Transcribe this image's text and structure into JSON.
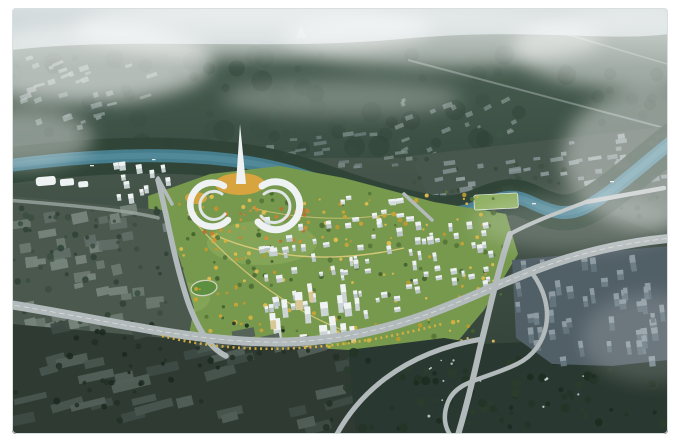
{
  "scene": {
    "description": "Aerial masterplan rendering: misty forested mountain, teal river, colorful new town center with crescent landmark buildings and spire, highway interchange, surrounding grey city blocks, industrial sheds and residential slabs",
    "kind": "architectural-aerial-rendering"
  },
  "colors": {
    "frame_white": "#ffffff",
    "sky_top": "#a9b8ba",
    "sky_bottom": "#8aa0a0",
    "mountain_top": "#4a5f52",
    "mountain_bottom": "#33463c",
    "land_top": "#46564b",
    "land_bottom": "#2f3e34",
    "east_zone": "#47574d",
    "river": "#477e8e",
    "river_core": "#5b93a3",
    "river_bank": "#2f4537",
    "dev_green": "#77994e",
    "dev_park": "#8fae5e",
    "stadium_green": "#5d8f41",
    "stadium_ring": "#ccd2bc",
    "green_roof": "#8fb062",
    "plaza_orange": "#dca43e",
    "building_white": "#eef2f3",
    "building_inner": "#dfe6e5",
    "path_gold": "#e4cf7e",
    "tree_line_yellow": "#d8b23e",
    "road_light": "#b3babb",
    "road_lane": "#e8ecec",
    "road_minor": "#9aa8a2",
    "left_city_base": "#4a584e",
    "industrial_base": "#2e3a32",
    "forest_base": "#293830",
    "residential_base": "#515f66",
    "fog": "#ffffff",
    "border": "#d9dede"
  },
  "scatters": [
    {
      "target": "mountain-texture",
      "name": "mountain-foliage",
      "type": "dot",
      "region": [
        0,
        46,
        656,
        148
      ],
      "count": 150,
      "rmin": 3,
      "rmax": 11,
      "colors": [
        "#3b5044",
        "#324539",
        "#43594a",
        "#2d3f34"
      ],
      "opacity": 0.38,
      "seed": 11
    },
    {
      "target": "distant-city-tl",
      "name": "distant-building",
      "type": "rect",
      "region": [
        8,
        50,
        132,
        72
      ],
      "count": 32,
      "wmin": 4,
      "wmax": 12,
      "hmin": 2.5,
      "hmax": 6,
      "rot": -18,
      "jitter": 10,
      "colors": [
        "#aab7b7",
        "#b8c3c3",
        "#9dacac"
      ],
      "opacity": 0.5,
      "seed": 12
    },
    {
      "target": "distant-city-tr",
      "name": "distant-building",
      "type": "rect",
      "region": [
        372,
        90,
        168,
        80
      ],
      "count": 30,
      "wmin": 3,
      "wmax": 10,
      "hmin": 2.5,
      "hmax": 5,
      "rot": -25,
      "jitter": 12,
      "colors": [
        "#a3b1b1",
        "#afbcbc"
      ],
      "opacity": 0.45,
      "seed": 13
    },
    {
      "target": "northbank-town-west",
      "name": "town-block",
      "type": "rect",
      "region": [
        246,
        126,
        152,
        36
      ],
      "count": 20,
      "wmin": 5,
      "wmax": 13,
      "hmin": 2.5,
      "hmax": 4.5,
      "rot": -6,
      "jitter": 6,
      "colors": [
        "#8a9997",
        "#7a8a8b"
      ],
      "opacity": 0.65,
      "seed": 14
    },
    {
      "target": "northbank-town-mid",
      "name": "town-block",
      "type": "rect",
      "region": [
        420,
        150,
        120,
        52
      ],
      "count": 22,
      "wmin": 5,
      "wmax": 14,
      "hmin": 3,
      "hmax": 5.5,
      "rot": -8,
      "jitter": 8,
      "colors": [
        "#94a2a2",
        "#a1aeae",
        "#879696"
      ],
      "opacity": 0.8,
      "seed": 15
    },
    {
      "target": "northbank-town-east",
      "name": "town-block",
      "type": "rect",
      "region": [
        544,
        126,
        112,
        50
      ],
      "count": 26,
      "wmin": 5,
      "wmax": 14,
      "hmin": 3,
      "hmax": 5.5,
      "rot": -8,
      "jitter": 8,
      "colors": [
        "#94a2a2",
        "#a1aeae",
        "#879696"
      ],
      "opacity": 0.8,
      "seed": 35
    },
    {
      "target": "east-zone-trees",
      "name": "tree",
      "type": "dot",
      "region": [
        400,
        150,
        256,
        60
      ],
      "count": 40,
      "rmin": 1.5,
      "rmax": 3,
      "colors": [
        "#3c5142",
        "#334639"
      ],
      "opacity": 0.7,
      "seed": 31
    },
    {
      "target": "dev-green-trees",
      "name": "tree",
      "type": "dot",
      "region": [
        140,
        182,
        352,
        172
      ],
      "count": 95,
      "rmin": 1.2,
      "rmax": 3,
      "colors": [
        "#4c6a35",
        "#557538",
        "#42602e"
      ],
      "opacity": 0.9,
      "seed": 16
    },
    {
      "target": "dev-yellow-trees",
      "name": "autumn-tree",
      "type": "dot",
      "region": [
        146,
        186,
        336,
        160
      ],
      "count": 170,
      "rmin": 1,
      "rmax": 2.4,
      "colors": [
        "#d5b13d",
        "#c9a435",
        "#e0bd4e",
        "#b99a30"
      ],
      "opacity": 0.95,
      "seed": 17
    },
    {
      "target": "dev-orange-trees",
      "name": "autumn-tree",
      "type": "dot",
      "region": [
        188,
        198,
        110,
        36
      ],
      "count": 40,
      "rmin": 1,
      "rmax": 2.2,
      "colors": [
        "#c97f35",
        "#d18f3a",
        "#bd6f2e"
      ],
      "opacity": 0.95,
      "seed": 18
    },
    {
      "target": "dev-buildings",
      "name": "new-town-building",
      "type": "rect",
      "region": [
        250,
        212,
        162,
        96
      ],
      "count": 58,
      "wmin": 3,
      "wmax": 6.5,
      "hmin": 4,
      "hmax": 10,
      "rot": -8,
      "jitter": 6,
      "colors": [
        "#c5ced0",
        "#bcc6c8"
      ],
      "cap": "#edf1f2",
      "opacity": 1,
      "seed": 19
    },
    {
      "target": "dev-buildings-east",
      "name": "new-town-building",
      "type": "rect",
      "region": [
        400,
        212,
        82,
        66
      ],
      "count": 26,
      "wmin": 3,
      "wmax": 6.5,
      "hmin": 4,
      "hmax": 9,
      "rot": -8,
      "jitter": 6,
      "colors": [
        "#c5ced0",
        "#bcc6c8"
      ],
      "cap": "#edf1f2",
      "opacity": 1,
      "seed": 20
    },
    {
      "target": "dev-cbd-towers",
      "name": "cbd-tower",
      "type": "rect",
      "region": [
        256,
        282,
        92,
        56
      ],
      "count": 18,
      "wmin": 4.5,
      "wmax": 8,
      "hmin": 12,
      "hmax": 22,
      "rot": -6,
      "jitter": 4,
      "colors": [
        "#ccd4d5",
        "#d8c896"
      ],
      "cap": "#f0f3f4",
      "opacity": 1,
      "seed": 21
    },
    {
      "target": "dev-west-offices",
      "name": "office-building",
      "type": "rect",
      "region": [
        104,
        156,
        58,
        42
      ],
      "count": 13,
      "wmin": 4,
      "wmax": 7,
      "hmin": 6,
      "hmax": 12,
      "rot": -8,
      "jitter": 5,
      "colors": [
        "#c9d2d3"
      ],
      "cap": "#eef2f3",
      "opacity": 1,
      "seed": 22
    },
    {
      "target": "dev-north-strip",
      "name": "riverfront-hall",
      "type": "rect",
      "region": [
        330,
        188,
        72,
        30
      ],
      "count": 12,
      "wmin": 4,
      "wmax": 8,
      "hmin": 3.5,
      "hmax": 6,
      "rot": -6,
      "jitter": 5,
      "colors": [
        "#d4dbdc"
      ],
      "cap": "#f1f4f4",
      "opacity": 1,
      "seed": 23
    },
    {
      "target": "left-city-blocks",
      "name": "city-block",
      "type": "rect",
      "region": [
        6,
        198,
        152,
        128
      ],
      "count": 44,
      "wmin": 8,
      "wmax": 20,
      "hmin": 5,
      "hmax": 11,
      "rot": -10,
      "jitter": 8,
      "colors": [
        "#5f6e66",
        "#6a796f",
        "#76857b"
      ],
      "opacity": 0.95,
      "seed": 24
    },
    {
      "target": "left-city-trees",
      "name": "tree",
      "type": "dot",
      "region": [
        0,
        195,
        160,
        135
      ],
      "count": 60,
      "rmin": 1.5,
      "rmax": 3.5,
      "colors": [
        "#3a4e40",
        "#2f4236"
      ],
      "opacity": 0.85,
      "seed": 25
    },
    {
      "target": "industrial-rows",
      "name": "warehouse",
      "type": "rect",
      "region": [
        4,
        318,
        330,
        102
      ],
      "count": 36,
      "wmin": 16,
      "wmax": 40,
      "hmin": 6,
      "hmax": 11,
      "rot": -14,
      "jitter": 5,
      "colors": [
        "#49554f",
        "#525f58",
        "#3e4a44"
      ],
      "opacity": 0.95,
      "seed": 26
    },
    {
      "target": "industrial-trees",
      "name": "tree",
      "type": "dot",
      "region": [
        0,
        315,
        335,
        108
      ],
      "count": 55,
      "rmin": 1.5,
      "rmax": 3.5,
      "colors": [
        "#223126",
        "#1c2a20"
      ],
      "opacity": 0.9,
      "seed": 27
    },
    {
      "target": "se-forest-trees",
      "name": "tree",
      "type": "dot",
      "region": [
        335,
        342,
        318,
        82
      ],
      "count": 75,
      "rmin": 2,
      "rmax": 5,
      "colors": [
        "#243427",
        "#1d2b20",
        "#2b3d2e"
      ],
      "opacity": 0.9,
      "seed": 28
    },
    {
      "target": "se-forest-houses",
      "name": "village-house",
      "type": "dot",
      "region": [
        360,
        350,
        280,
        66
      ],
      "count": 16,
      "rmin": 0.8,
      "rmax": 1.5,
      "colors": [
        "#cfd8d8",
        "#dde4e4"
      ],
      "opacity": 0.85,
      "seed": 29
    },
    {
      "target": "right-res-slabs",
      "name": "residential-slab",
      "type": "rect",
      "region": [
        504,
        254,
        148,
        100
      ],
      "count": 48,
      "wmin": 4,
      "wmax": 7,
      "hmin": 9,
      "hmax": 17,
      "rot": -7,
      "jitter": 5,
      "colors": [
        "#6e7e87",
        "#64747d"
      ],
      "cap": "#8d9aa1",
      "opacity": 1,
      "seed": 30
    }
  ]
}
